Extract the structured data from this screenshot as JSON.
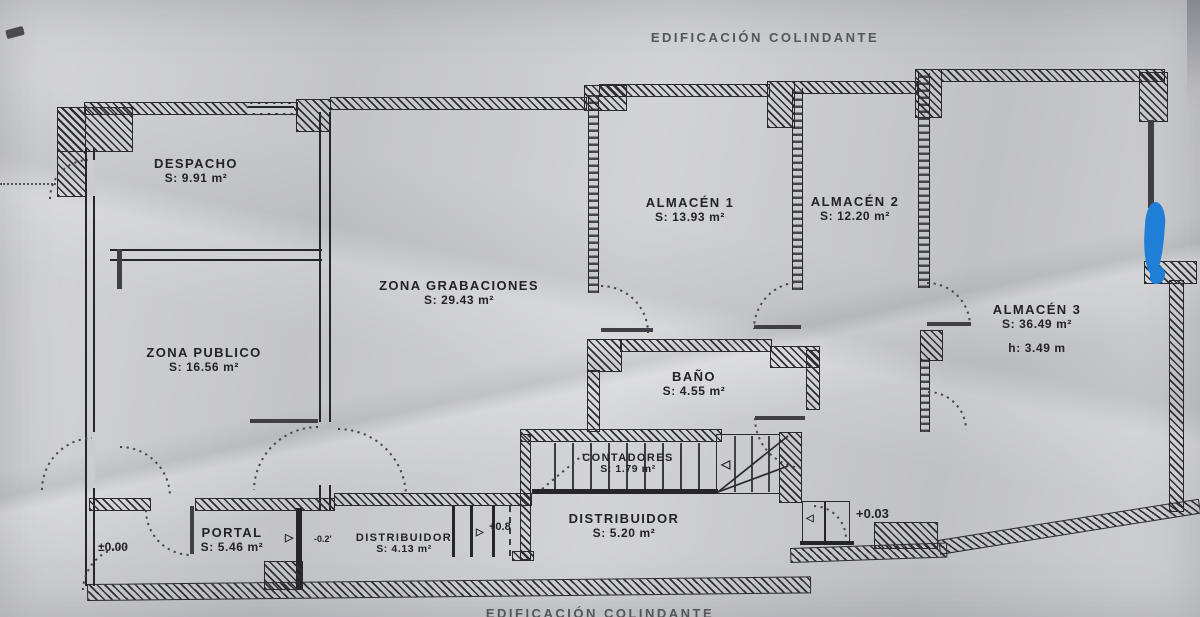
{
  "plan": {
    "type": "scanned architectural floor plan",
    "top_boundary_label": "EDIFICACIÓN COLINDANTE",
    "bottom_boundary_label": "EDIFICACIÓN COLINDANTE"
  },
  "rooms": [
    {
      "name": "DESPACHO",
      "area": "S: 9.91 m²"
    },
    {
      "name": "ZONA PUBLICO",
      "area": "S: 16.56 m²"
    },
    {
      "name": "ZONA GRABACIONES",
      "area": "S: 29.43 m²"
    },
    {
      "name": "ALMACÉN 1",
      "area": "S: 13.93 m²"
    },
    {
      "name": "ALMACÉN 2",
      "area": "S: 12.20 m²"
    },
    {
      "name": "ALMACÉN 3",
      "area": "S: 36.49 m²",
      "height": "h: 3.49 m"
    },
    {
      "name": "BAÑO",
      "area": "S: 4.55 m²"
    },
    {
      "name": "CONTADORES",
      "area": "S: 1.79 m²"
    },
    {
      "name": "DISTRIBUIDOR",
      "area": "S: 5.20 m²"
    },
    {
      "name": "DISTRIBUIDOR",
      "area": "S: 4.13 m²"
    },
    {
      "name": "PORTAL",
      "area": "S: 5.46 m²"
    }
  ],
  "level_markers": {
    "portal_entry": "±0.00",
    "portal_step": "-0.2'",
    "distribuidor_step": "+0.8",
    "almacen_step": "+0.03"
  },
  "symbols": {
    "threshold_right": "▷",
    "threshold_left": "◁"
  },
  "colors": {
    "paper": "#cbccd0",
    "ink": "#26262a",
    "pen_annotation": "#1f7fd6"
  }
}
